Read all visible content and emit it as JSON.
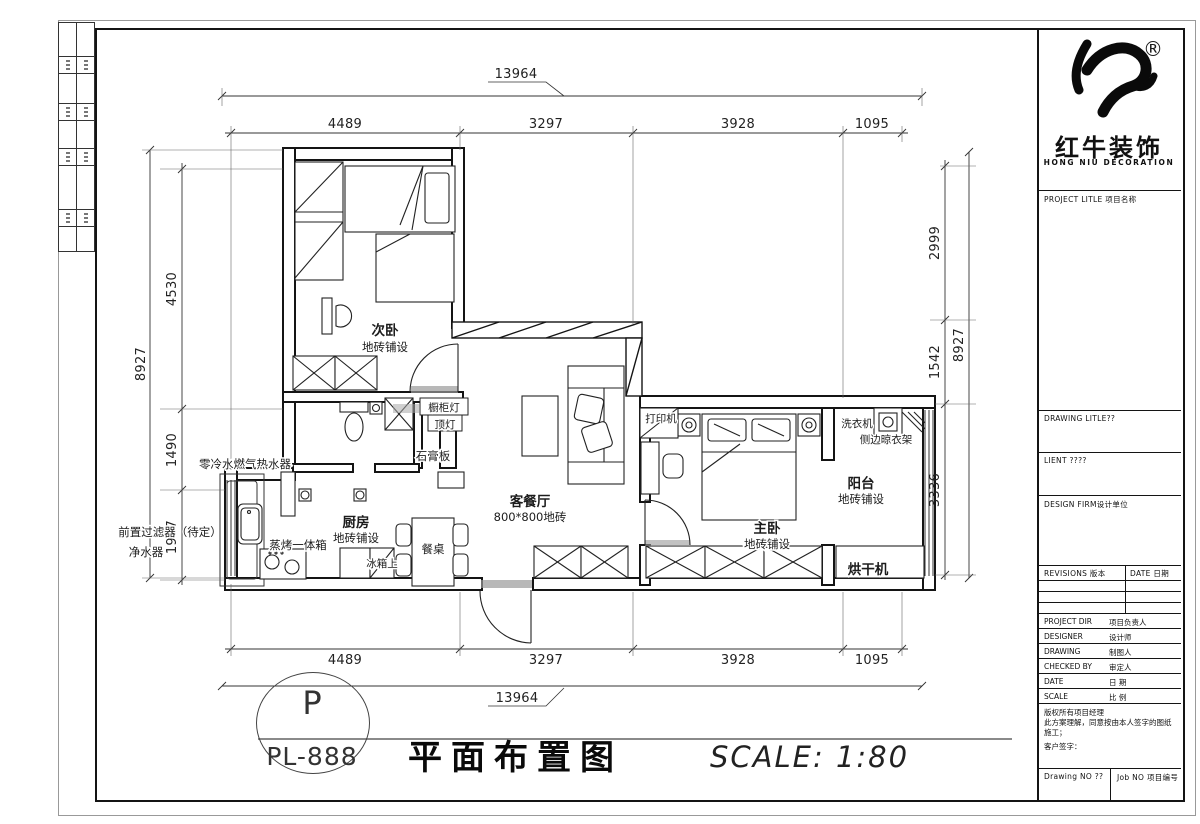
{
  "logo": {
    "registered": "®",
    "brand_cn": "红牛装饰",
    "brand_en": "HONG NIU DECORATION"
  },
  "title_block": {
    "project_label": "PROJECT LITLE  项目名称",
    "drawing_title_label": "DRAWING  LITLE??",
    "client_label": "LIENT ????",
    "design_firm_label": "DESIGN  FIRM设计单位",
    "revisions_label": "REVISIONS  版本",
    "revision_date_label": "DATE  日期",
    "signature_rows": [
      {
        "en": "PROJECT DIR",
        "cn": "项目负责人"
      },
      {
        "en": "DESIGNER",
        "cn": "设计师"
      },
      {
        "en": "DRAWING",
        "cn": "制图人"
      },
      {
        "en": "CHECKED BY",
        "cn": "审定人"
      },
      {
        "en": "DATE",
        "cn": "日 期"
      },
      {
        "en": "SCALE",
        "cn": "比 例"
      }
    ],
    "copyright_line1": "版权所有项目经理",
    "copyright_line2": "此方案理解，同意按由本人签字的图纸施工；",
    "copyright_line3": "客户签字：",
    "drawing_no_label": "Drawing NO ??",
    "job_no_label": "Job NO 项目编号"
  },
  "title_bar": {
    "badge_top": "P",
    "badge_bottom": "PL-888",
    "drawing_title": "平面布置图",
    "scale_text": "SCALE:  1:80"
  },
  "dimensions": {
    "top": {
      "overall": "13964",
      "segments": [
        "4489",
        "3297",
        "3928",
        "1095"
      ]
    },
    "bottom": {
      "overall": "13964",
      "segments": [
        "4489",
        "3297",
        "3928",
        "1095"
      ]
    },
    "left": {
      "overall": "8927",
      "segments": [
        "4530",
        "1490",
        "1907"
      ]
    },
    "right": {
      "overall": "8927",
      "segments": [
        "2999",
        "1542",
        "3336"
      ]
    }
  },
  "rooms": {
    "bedroom2": {
      "name": "次卧",
      "finish": "地砖铺设"
    },
    "living": {
      "name": "客餐厅",
      "finish": "800*800地砖"
    },
    "master": {
      "name": "主卧",
      "finish": "地砖铺设"
    },
    "kitchen": {
      "name": "厨房",
      "finish": "地砖铺设"
    },
    "balcony": {
      "name": "阳台",
      "finish": "地砖铺设"
    }
  },
  "labels": {
    "water_heater": "零冷水燃气热水器",
    "pre_filter": "前置过滤器（待定）",
    "water_purifier": "净水器",
    "steam_oven": "蒸烤一体箱",
    "fridge": "冰箱上",
    "dining_table": "餐桌",
    "gypsum_board": "石膏板",
    "cabinet_light": "橱柜灯",
    "ceiling_light": "顶灯",
    "printer": "打印机",
    "washer": "洗衣机",
    "side_rack": "侧边晾衣架",
    "dryer": "烘干机"
  },
  "colors": {
    "paper": "#ffffff",
    "line": "#1c1c1c",
    "grey": "#8a8a8a"
  }
}
